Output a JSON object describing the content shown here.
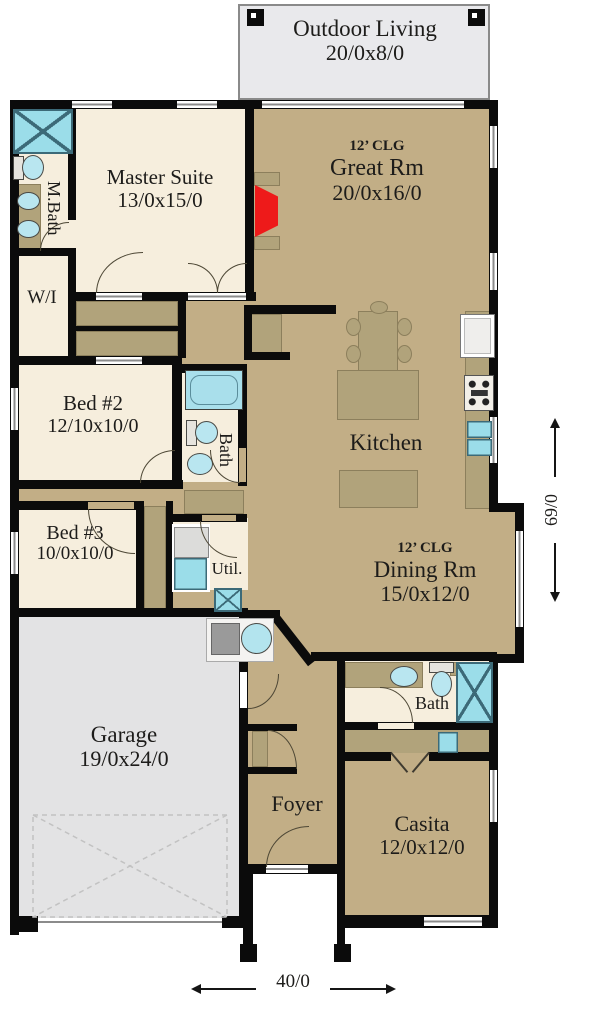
{
  "plan": {
    "outdoor_living": {
      "name": "Outdoor Living",
      "dims": "20/0x8/0"
    },
    "master_suite": {
      "name": "Master Suite",
      "dims": "13/0x15/0"
    },
    "great_room": {
      "ceiling": "12’ CLG",
      "name": "Great Rm",
      "dims": "20/0x16/0"
    },
    "master_bath": {
      "name": "M.Bath"
    },
    "walk_in_closet": {
      "name": "W/I"
    },
    "bedroom2": {
      "name": "Bed #2",
      "dims": "12/10x10/0"
    },
    "hall_bath": {
      "name": "Bath"
    },
    "kitchen": {
      "name": "Kitchen"
    },
    "bedroom3": {
      "name": "Bed #3",
      "dims": "10/0x10/0"
    },
    "utility": {
      "name": "Util."
    },
    "dining_room": {
      "ceiling": "12’ CLG",
      "name": "Dining Rm",
      "dims": "15/0x12/0"
    },
    "garage": {
      "name": "Garage",
      "dims": "19/0x24/0"
    },
    "casita_bath": {
      "name": "Bath"
    },
    "foyer": {
      "name": "Foyer"
    },
    "casita": {
      "name": "Casita",
      "dims": "12/0x12/0"
    },
    "overall_width": "40/0",
    "overall_depth": "69/0"
  },
  "colors": {
    "living_floor": "#c2ae86",
    "bedroom_floor": "#f6eedd",
    "garage_floor": "#e3e3e4",
    "outdoor_floor": "#e9e9ec",
    "fixture_teal": "#9bdde9",
    "fireplace_red": "#ee1a1a",
    "wall": "#0b0b0b"
  }
}
